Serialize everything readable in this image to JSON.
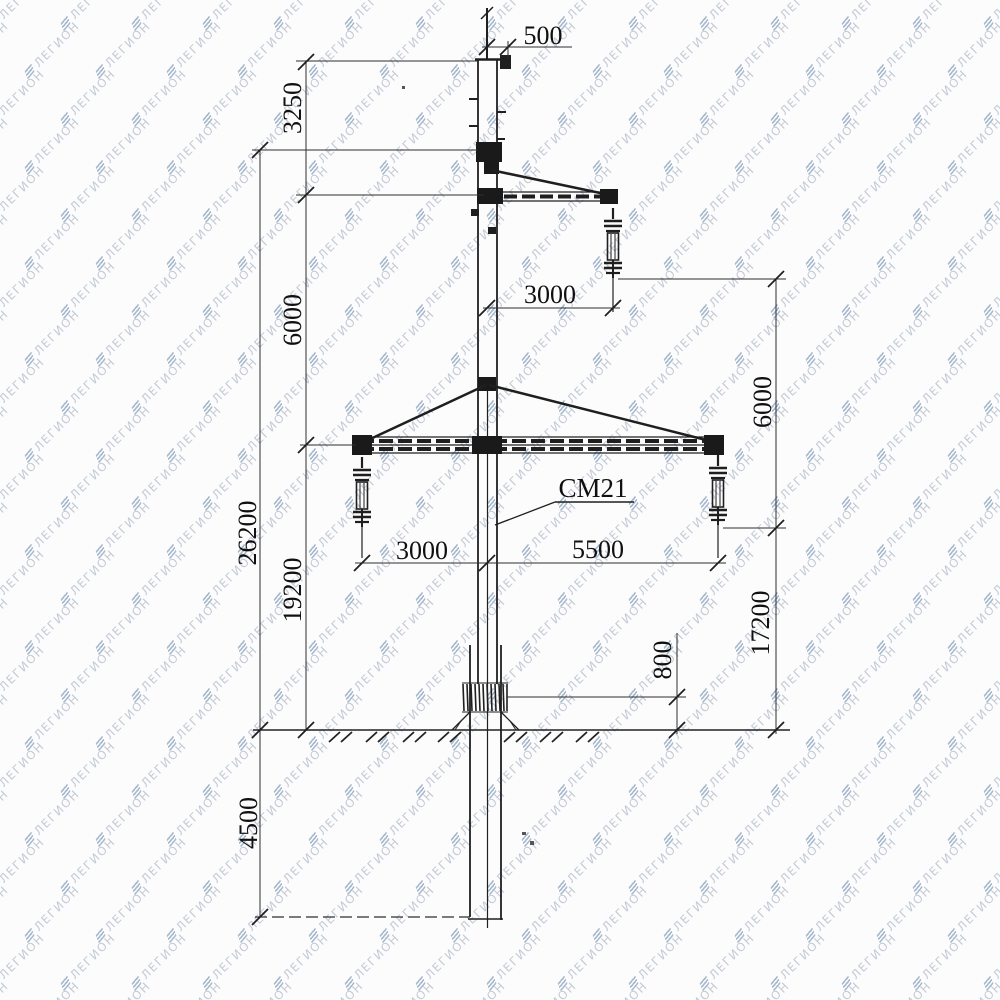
{
  "watermark": {
    "text": "ЛЕГИОН",
    "text_color": "#c3cad6",
    "icon_color": "#a3b6ca",
    "icon": "legion-layers-icon"
  },
  "drawing": {
    "ink_color": "#1f1f1f",
    "paper_color": "#fcfcfd",
    "structure_label": "СМ21",
    "dimensions": {
      "pole_top_width": "500",
      "top_to_upper_crossarm": "3250",
      "upper_wire_offset": "3000",
      "upper_to_lower_crossarm": "6000",
      "attachment_to_ground": "26200",
      "lower_crossarm_to_ground": "19200",
      "lower_left_wire_offset": "3000",
      "lower_right_wire_offset": "5500",
      "upper_wire_to_lower_wire": "6000",
      "lower_wire_to_ground": "17200",
      "foundation_top_above_ground": "800",
      "embedment_depth": "4500"
    }
  }
}
